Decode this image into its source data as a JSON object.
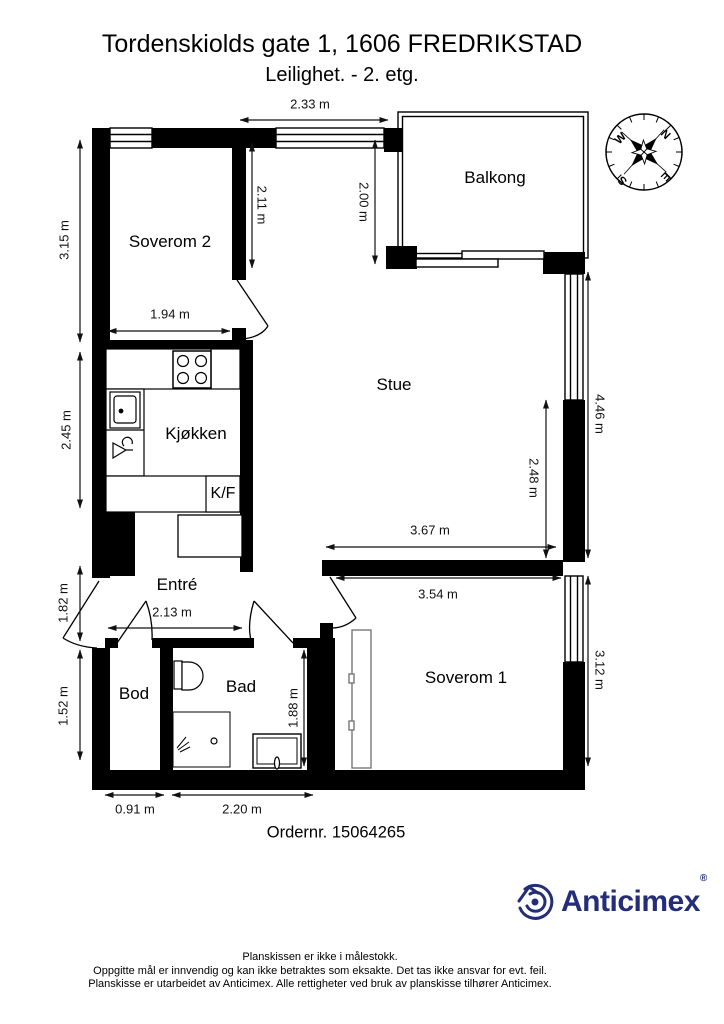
{
  "title": "Tordenskiolds gate 1, 1606 FREDRIKSTAD",
  "subtitle": "Leilighet.  - 2. etg.",
  "rooms": {
    "soverom2": "Soverom 2",
    "balkong": "Balkong",
    "stue": "Stue",
    "kjokken": "Kjøkken",
    "kf": "K/F",
    "entre": "Entré",
    "bod": "Bod",
    "bad": "Bad",
    "soverom1": "Soverom 1"
  },
  "dimensions": {
    "top_stue": "2.33 m",
    "sov2_left": "3.15 m",
    "sov2_inner": "2.11 m",
    "balkong_depth": "2.00 m",
    "sov2_width": "1.94 m",
    "kjokken_left": "2.45 m",
    "stue_right": "4.46 m",
    "stue_inner": "2.48 m",
    "stue_width": "3.67 m",
    "sov1_width": "3.54 m",
    "entre_left": "1.82 m",
    "entre_width": "2.13 m",
    "bod_left": "1.52 m",
    "bad_inner": "1.88 m",
    "sov1_right": "3.12 m",
    "bod_width": "0.91 m",
    "bad_width": "2.20 m"
  },
  "order_label": "Ordernr. 15064265",
  "compass": {
    "n": "N",
    "e": "E",
    "s": "S",
    "w": "W"
  },
  "logo": {
    "name": "Anticimex",
    "registered": "®",
    "color": "#232d78"
  },
  "footer": {
    "line1": "Planskissen er ikke i målestokk.",
    "line2": "Oppgitte mål er innvendig og kan ikke betraktes som eksakte. Det tas ikke ansvar for evt. feil.",
    "line3": "Planskisse er utarbeidet av Anticimex. Alle rettigheter ved bruk av planskisse tilhører Anticimex."
  }
}
